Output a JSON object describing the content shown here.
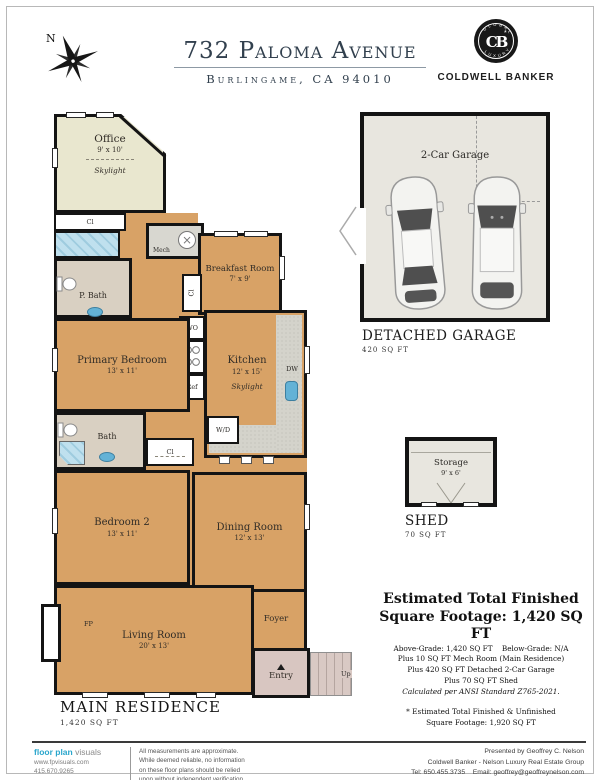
{
  "colors": {
    "wall": "#141414",
    "floor_tan": "#d8a266",
    "floor_office": "#e9e7cf",
    "floor_bath": "#d9d0c2",
    "floor_entry": "#d8c6c1",
    "floor_garage": "#e8e6df",
    "counter": "#d4d3cb",
    "sink_blue": "#63b2d6",
    "title_navy": "#32404e",
    "logo_blue": "#2aa6cc",
    "footer_blue": "#4e87a0"
  },
  "header": {
    "compass": "N",
    "title": "732 Paloma Avenue",
    "subtitle": "Burlingame, CA 94010",
    "brand": {
      "monogram": "CB",
      "arc_top": "GLOBAL",
      "arc_bottom": "LUXURY",
      "name": "COLDWELL BANKER"
    }
  },
  "plan": {
    "office": {
      "name": "Office",
      "dims": "9' x 10'",
      "note": "Skylight"
    },
    "office_closet": "Cl",
    "p_bath": "P. Bath",
    "mech": "Mech",
    "breakfast": {
      "name": "Breakfast Room",
      "dims": "7' x 9'"
    },
    "hall_closet": "Cl",
    "wo": "WO",
    "ref": "Ref",
    "primary_bedroom": {
      "name": "Primary Bedroom",
      "dims": "13' x 11'"
    },
    "kitchen": {
      "name": "Kitchen",
      "dims": "12' x 15'",
      "note": "Skylight"
    },
    "dw": "DW",
    "wd": "W/D",
    "bath": "Bath",
    "bath_closet": "Cl",
    "bedroom2": {
      "name": "Bedroom 2",
      "dims": "13' x 11'"
    },
    "dining": {
      "name": "Dining Room",
      "dims": "12' x 13'"
    },
    "foyer": "Foyer",
    "living": {
      "name": "Living Room",
      "dims": "20' x 13'"
    },
    "fireplace": "FP",
    "entry": "Entry",
    "up": "Up",
    "caption": "MAIN RESIDENCE",
    "area": "1,420 SQ FT"
  },
  "garage": {
    "room_label": "2-Car Garage",
    "caption": "DETACHED GARAGE",
    "area": "420 SQ FT"
  },
  "shed": {
    "room_label": "Storage",
    "dims": "9' x 6'",
    "caption": "SHED",
    "area": "70 SQ FT"
  },
  "summary": {
    "title_line1": "Estimated Total Finished",
    "title_line2": "Square Footage: 1,420 SQ FT",
    "above_grade": "Above-Grade: 1,420 SQ FT",
    "below_grade": "Below-Grade: N/A",
    "line_mech": "Plus 10 SQ FT Mech Room (Main Residence)",
    "line_garage": "Plus 420 SQ FT Detached 2-Car Garage",
    "line_shed": "Plus 70 SQ FT Shed",
    "line_ansi": "Calculated per ANSI Standard Z765-2021.",
    "footnote1": "* Estimated Total Finished & Unfinished",
    "footnote2": "Square Footage: 1,920 SQ FT"
  },
  "footer": {
    "logo_primary": "floor plan",
    "logo_secondary": "visuals",
    "website": "www.fpvisuals.com",
    "phone": "415.670.9265",
    "disclaimer": [
      "All measurements are approximate.",
      "While deemed reliable, no information",
      "on these floor plans should be relied",
      "upon without independent verification."
    ],
    "presented_by": "Presented by Geoffrey C. Nelson",
    "company": "Coldwell Banker - Nelson Luxury Real Estate Group",
    "tel": "Tel: 650.455.3735",
    "email": "Email: geoffrey@geoffreynelson.com"
  }
}
